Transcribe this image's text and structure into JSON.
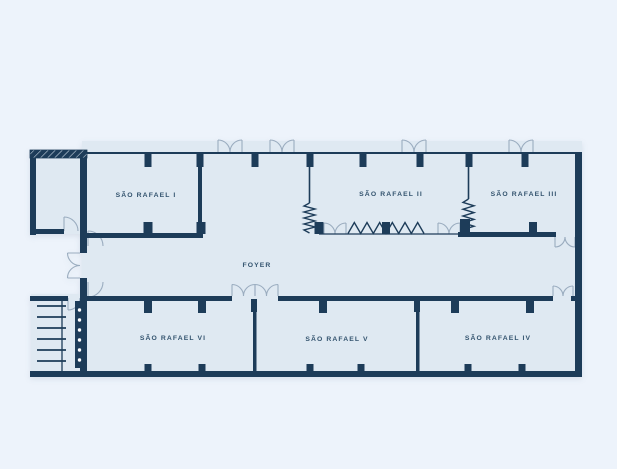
{
  "floorplan": {
    "rooms": {
      "sr1": "SÃO RAFAEL I",
      "sr2": "SÃO RAFAEL II",
      "sr3": "SÃO RAFAEL III",
      "sr4": "SÃO RAFAEL IV",
      "sr5": "SÃO RAFAEL V",
      "sr6": "SÃO RAFAEL VI",
      "foyer": "FOYER"
    },
    "colors": {
      "wall": "#1d3c59",
      "floor": "#dfe9f2",
      "background": "#edf3fb",
      "door_arc": "#9aacbf",
      "label": "#33536e",
      "stair_dot": "#ffffff"
    }
  }
}
